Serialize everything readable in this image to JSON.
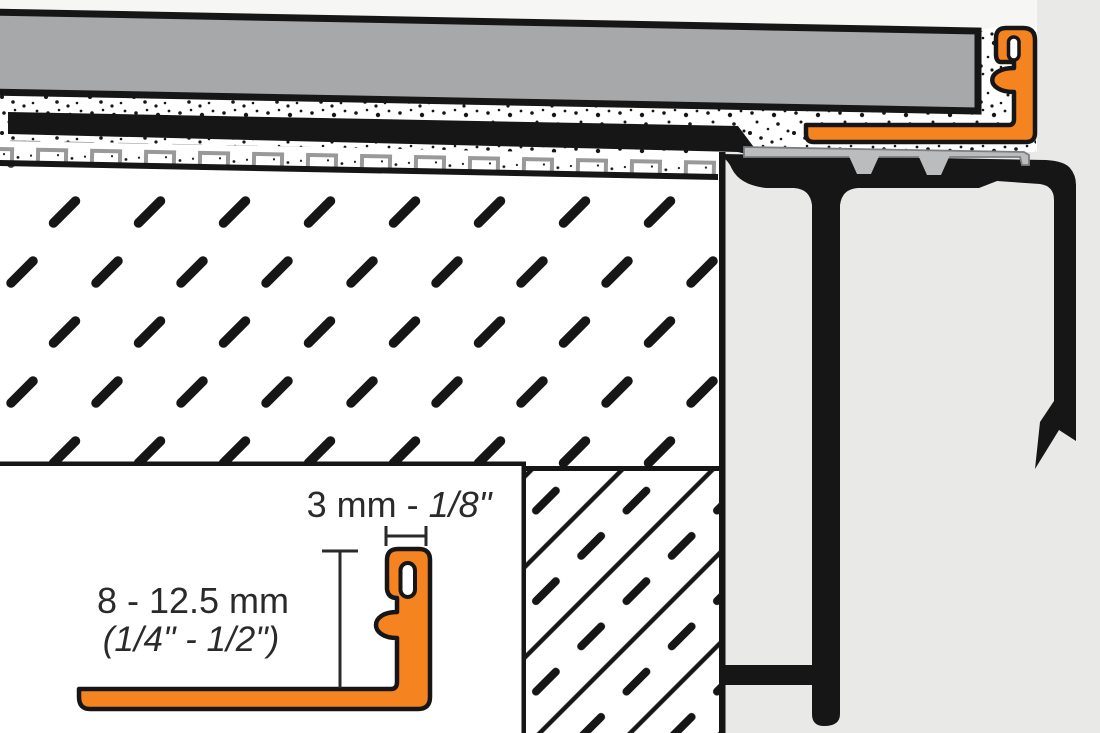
{
  "diagram": {
    "inset_dimensions": {
      "profile_width_metric": "3 mm - ",
      "profile_width_imperial": "1/8\"",
      "profile_height_metric": "8 - 12.5 mm",
      "profile_height_imperial": "(1/4\" - 1/2\")"
    }
  },
  "colors": {
    "profile_orange": "#f5831f",
    "tile_gray": "#a6a8aa",
    "support_plate_gray": "#babcbe",
    "membrane_gray": "#98999b",
    "line_black": "#161616",
    "background_gray": "#e9eae8",
    "air_white": "#f6f6f4"
  }
}
